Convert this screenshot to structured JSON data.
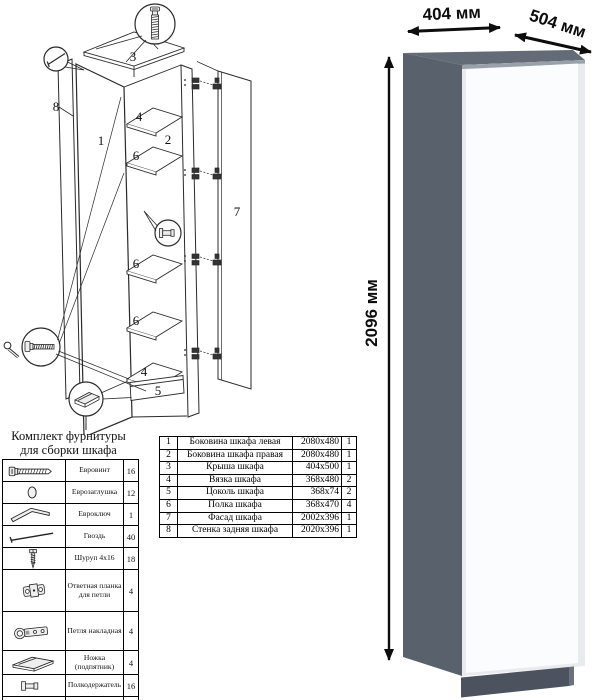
{
  "diagram": {
    "labels": {
      "part1": "1",
      "part2": "2",
      "part3": "3",
      "part4_top": "4",
      "part6_a": "6",
      "part6_b": "6",
      "part6_c": "6",
      "part4_bottom": "4",
      "part5": "5",
      "part7": "7",
      "part8": "8"
    }
  },
  "hardware_table": {
    "title_line1": "Комплект фурнитуры",
    "title_line2": "для сборки шкафа",
    "rows": [
      {
        "icon": "euro-screw",
        "name": "Евровинт",
        "qty": "16"
      },
      {
        "icon": "euro-cap",
        "name": "Еврозаглушка",
        "qty": "12"
      },
      {
        "icon": "euro-key",
        "name": "Евроключ",
        "qty": "1"
      },
      {
        "icon": "nail",
        "name": "Гвоздь",
        "qty": "40"
      },
      {
        "icon": "screw",
        "name": "Шуруп 4x16",
        "qty": "18"
      },
      {
        "icon": "hinge-plate",
        "name": "Ответная планка для петли",
        "qty": "4"
      },
      {
        "icon": "hinge",
        "name": "Петля накладная",
        "qty": "4"
      },
      {
        "icon": "foot",
        "name": "Ножка (подпятник)",
        "qty": "4"
      },
      {
        "icon": "shelf-pin",
        "name": "Полкодержатель",
        "qty": "16"
      },
      {
        "icon": "push-rod",
        "name": "Толкатель (пуш)",
        "qty": "1"
      }
    ]
  },
  "parts_table": {
    "rows": [
      {
        "num": "1",
        "name": "Боковина шкафа левая",
        "size": "2080x480",
        "qty": "1"
      },
      {
        "num": "2",
        "name": "Боковина шкафа правая",
        "size": "2080x480",
        "qty": "1"
      },
      {
        "num": "3",
        "name": "Крыша шкафа",
        "size": "404x500",
        "qty": "1"
      },
      {
        "num": "4",
        "name": "Вязка шкафа",
        "size": "368x480",
        "qty": "2"
      },
      {
        "num": "5",
        "name": "Цоколь шкафа",
        "size": "368x74",
        "qty": "2"
      },
      {
        "num": "6",
        "name": "Полка шкафа",
        "size": "368x470",
        "qty": "4"
      },
      {
        "num": "7",
        "name": "Фасад шкафа",
        "size": "2002x396",
        "qty": "1"
      },
      {
        "num": "8",
        "name": "Стенка задняя шкафа",
        "size": "2020x396",
        "qty": "1"
      }
    ]
  },
  "render": {
    "width_label": "404 мм",
    "depth_label": "504 мм",
    "height_label": "2096 мм",
    "colors": {
      "top": "#636b76",
      "side": "#59616c",
      "door": "#fbfcfd",
      "plinth": "#4c535e"
    }
  }
}
